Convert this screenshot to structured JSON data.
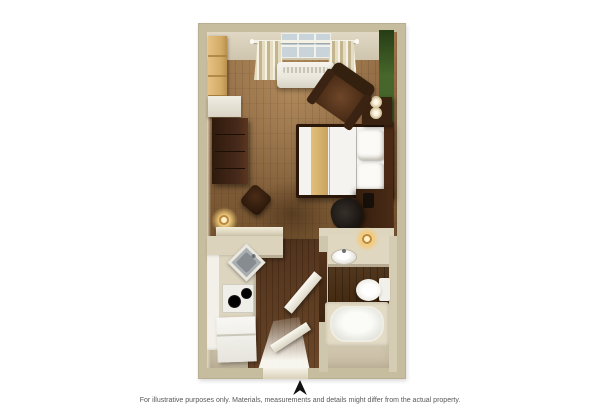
{
  "figure": {
    "type": "3d-floor-plan",
    "disclaimer": "For illustrative purposes only.  Materials, measurements and details might differ from the actual property.",
    "compass_direction": "north"
  },
  "palette": {
    "bg": "#ffffff",
    "wall_outer": "#c6bc9e",
    "wall_face": "#dcd3be",
    "floor_base": "#cfc5ac",
    "floor_wood": "#8a6540",
    "floor_walnut": "#59381f",
    "green_wall": "#3c5a24",
    "counter": "#dcd3bc",
    "cabinet_white": "#f0eee6",
    "closet_wood": "#dcb876",
    "wood_dark": "#3e2413",
    "bedding": "#f4f3ef",
    "runner": "#d9b873",
    "fixture_white": "#f2f1ec",
    "steel": "#a6abae",
    "glow": "#ffe9b8",
    "text": "#585858",
    "arrow": "#111111"
  },
  "items": [
    "window-with-curtains",
    "ptac-ac-unit",
    "closet-shelves",
    "wardrobe-shelf",
    "dresser",
    "armchair",
    "ottoman",
    "queen-bed",
    "bed-runner",
    "nightstand",
    "double-table-lamp",
    "desk",
    "desk-chair",
    "floor-lamp",
    "kitchen-peninsula",
    "corner-sink",
    "two-burner-cooktop",
    "refrigerator",
    "vanity-counter",
    "vanity-sink",
    "vanity-lamp",
    "toilet",
    "bathtub",
    "bathroom-door",
    "entry-door",
    "north-arrow"
  ]
}
